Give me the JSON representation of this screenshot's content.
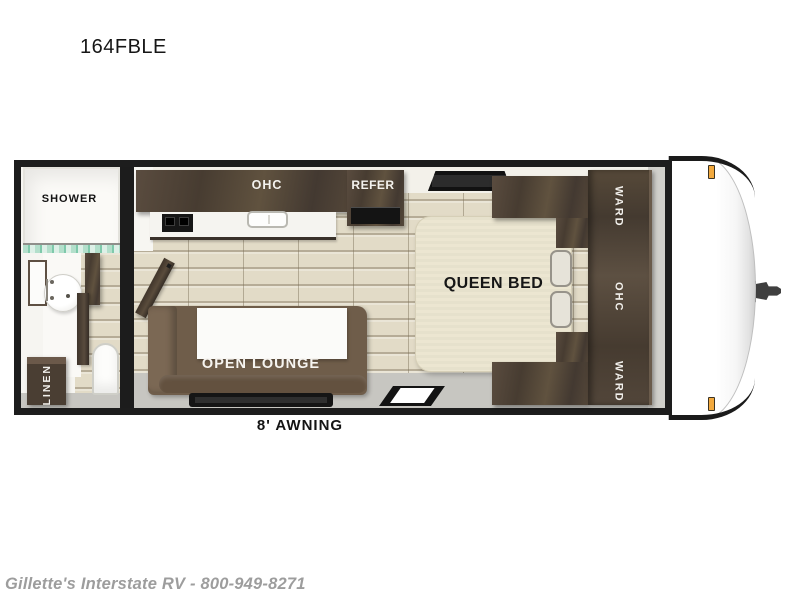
{
  "title": "164FBLE",
  "plan": {
    "bathroom": {
      "shower_label": "SHOWER",
      "linen_label": "LINEN"
    },
    "kitchen": {
      "ohc_label": "OHC",
      "refer_label": "REFER"
    },
    "lounge": {
      "label": "OPEN LOUNGE"
    },
    "bedroom": {
      "bed_label": "QUEEN BED",
      "ward_top_label": "WARD",
      "ohc_label": "OHC",
      "ward_bottom_label": "WARD"
    },
    "exterior": {
      "awning_label": "8' AWNING"
    }
  },
  "footer": {
    "dealer_line": "Gillette's Interstate RV - 800-949-8271"
  },
  "colors": {
    "outline": "#1d1d1d",
    "cabinet_wood": "#4c4034",
    "floor_wood": "#e2dbc7",
    "walkway_gray": "#c7c6c1",
    "bed_cream": "#ece6d1",
    "sofa_brown": "#6f5d4a",
    "shower_glass": "#7fc9ab",
    "marker_light": "#f2a93e"
  }
}
